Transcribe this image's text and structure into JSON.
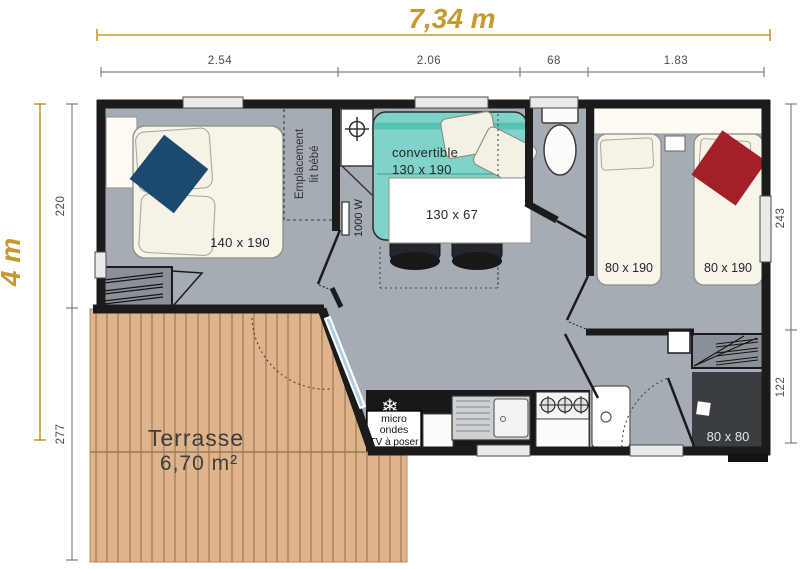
{
  "plan": {
    "width_label": "7,34 m",
    "height_label": "4 m"
  },
  "dimensions": {
    "top": [
      "2.54",
      "2.06",
      "68",
      "1.83"
    ],
    "left": [
      "220",
      "277"
    ],
    "right": [
      "243",
      "122"
    ]
  },
  "rooms": {
    "bedroom_master": {
      "bed_label": "140 x 190",
      "baby_bed_line1": "Emplacement",
      "baby_bed_line2": "lit bébé"
    },
    "living": {
      "sofa_line1": "convertible",
      "sofa_line2": "130 x 190",
      "table_label": "130 x 67",
      "heater_label": "1000 W"
    },
    "bedroom_twin": {
      "bed1_label": "80 x 190",
      "bed2_label": "80 x 190"
    },
    "bathroom": {
      "shower_label": "80 x 80"
    },
    "kitchen": {
      "appliance_line1": "micro",
      "appliance_line2": "ondes",
      "appliance_line3": "TV à poser"
    },
    "terrace": {
      "name": "Terrasse",
      "area": "6,70 m²"
    }
  },
  "icons": {
    "snowflake": "❄"
  },
  "colors": {
    "gold": "#c79a2f",
    "wall": "#1b1b1b",
    "floor": "#a6acb4",
    "deck": "#dfb48c",
    "deck_line": "#9b7a54",
    "sofa": "#7fd3c8",
    "sofa_dark": "#58c2b5",
    "bed": "#f8f4e9",
    "blanket_blue": "#1c4a6e",
    "blanket_red": "#a32028",
    "counter": "#17181a",
    "shower": "#3a3d41",
    "wardrobe": "#8a9098"
  }
}
